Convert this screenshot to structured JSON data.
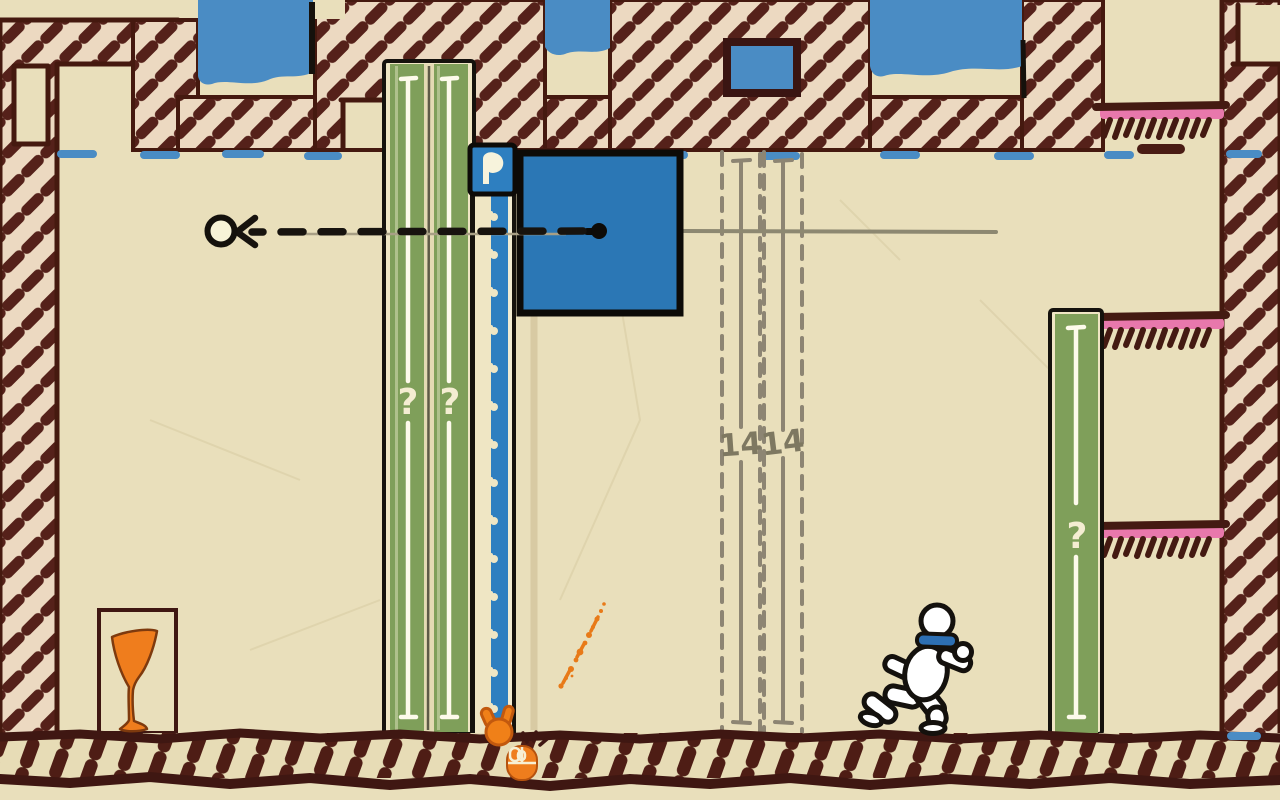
{
  "scene": {
    "type": "hand-drawn paper puzzle platformer level",
    "labels": {
      "left_strip_q1": "?",
      "left_strip_q2": "?",
      "right_strip_q": "?",
      "ghost_value_1": "14",
      "ghost_value_2": "14"
    },
    "palette": {
      "paper": "#e9dfbb",
      "wall_fill": "#ecd9c1",
      "wall_ink": "#4a1c14",
      "outline_black": "#15120d",
      "sky_blue": "#4a8cc4",
      "box_blue": "#2b77b5",
      "zipper_blue": "#2e7fc0",
      "strip_green": "#7f9f5a",
      "cream": "#efe6c4",
      "ledge_pink": "#e878ac",
      "orange": "#ef7d1d",
      "ghost_gray": "#8d8573",
      "tan_guide": "#d8caa3"
    },
    "icons": {
      "zipper_pull": "zipper-pull-tab",
      "mouse_hint": "mouse-left-click-icon",
      "hand_cursor": "orange-hand-cursor",
      "goblet": "goblet-in-doorway",
      "player": "running-character-with-blue-scarf",
      "target_circle": "aim-target-circle",
      "aim_arrow": "dashed-aim-arrow"
    }
  }
}
